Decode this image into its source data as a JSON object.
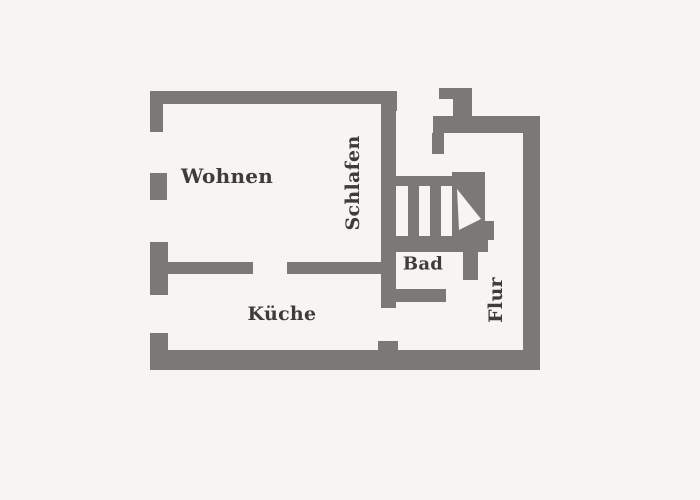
{
  "plan": {
    "rooms": {
      "wohnen": "Wohnen",
      "schlafen": "Schlafen",
      "kueche": "Küche",
      "bad": "Bad",
      "flur": "Flur"
    },
    "colors": {
      "background": "#f6f5f3",
      "wall": "#7b7875",
      "label": "#3d3c3a"
    },
    "icons": {
      "stair_direction_arrow": "white-triangle-pointing-down-right"
    }
  }
}
